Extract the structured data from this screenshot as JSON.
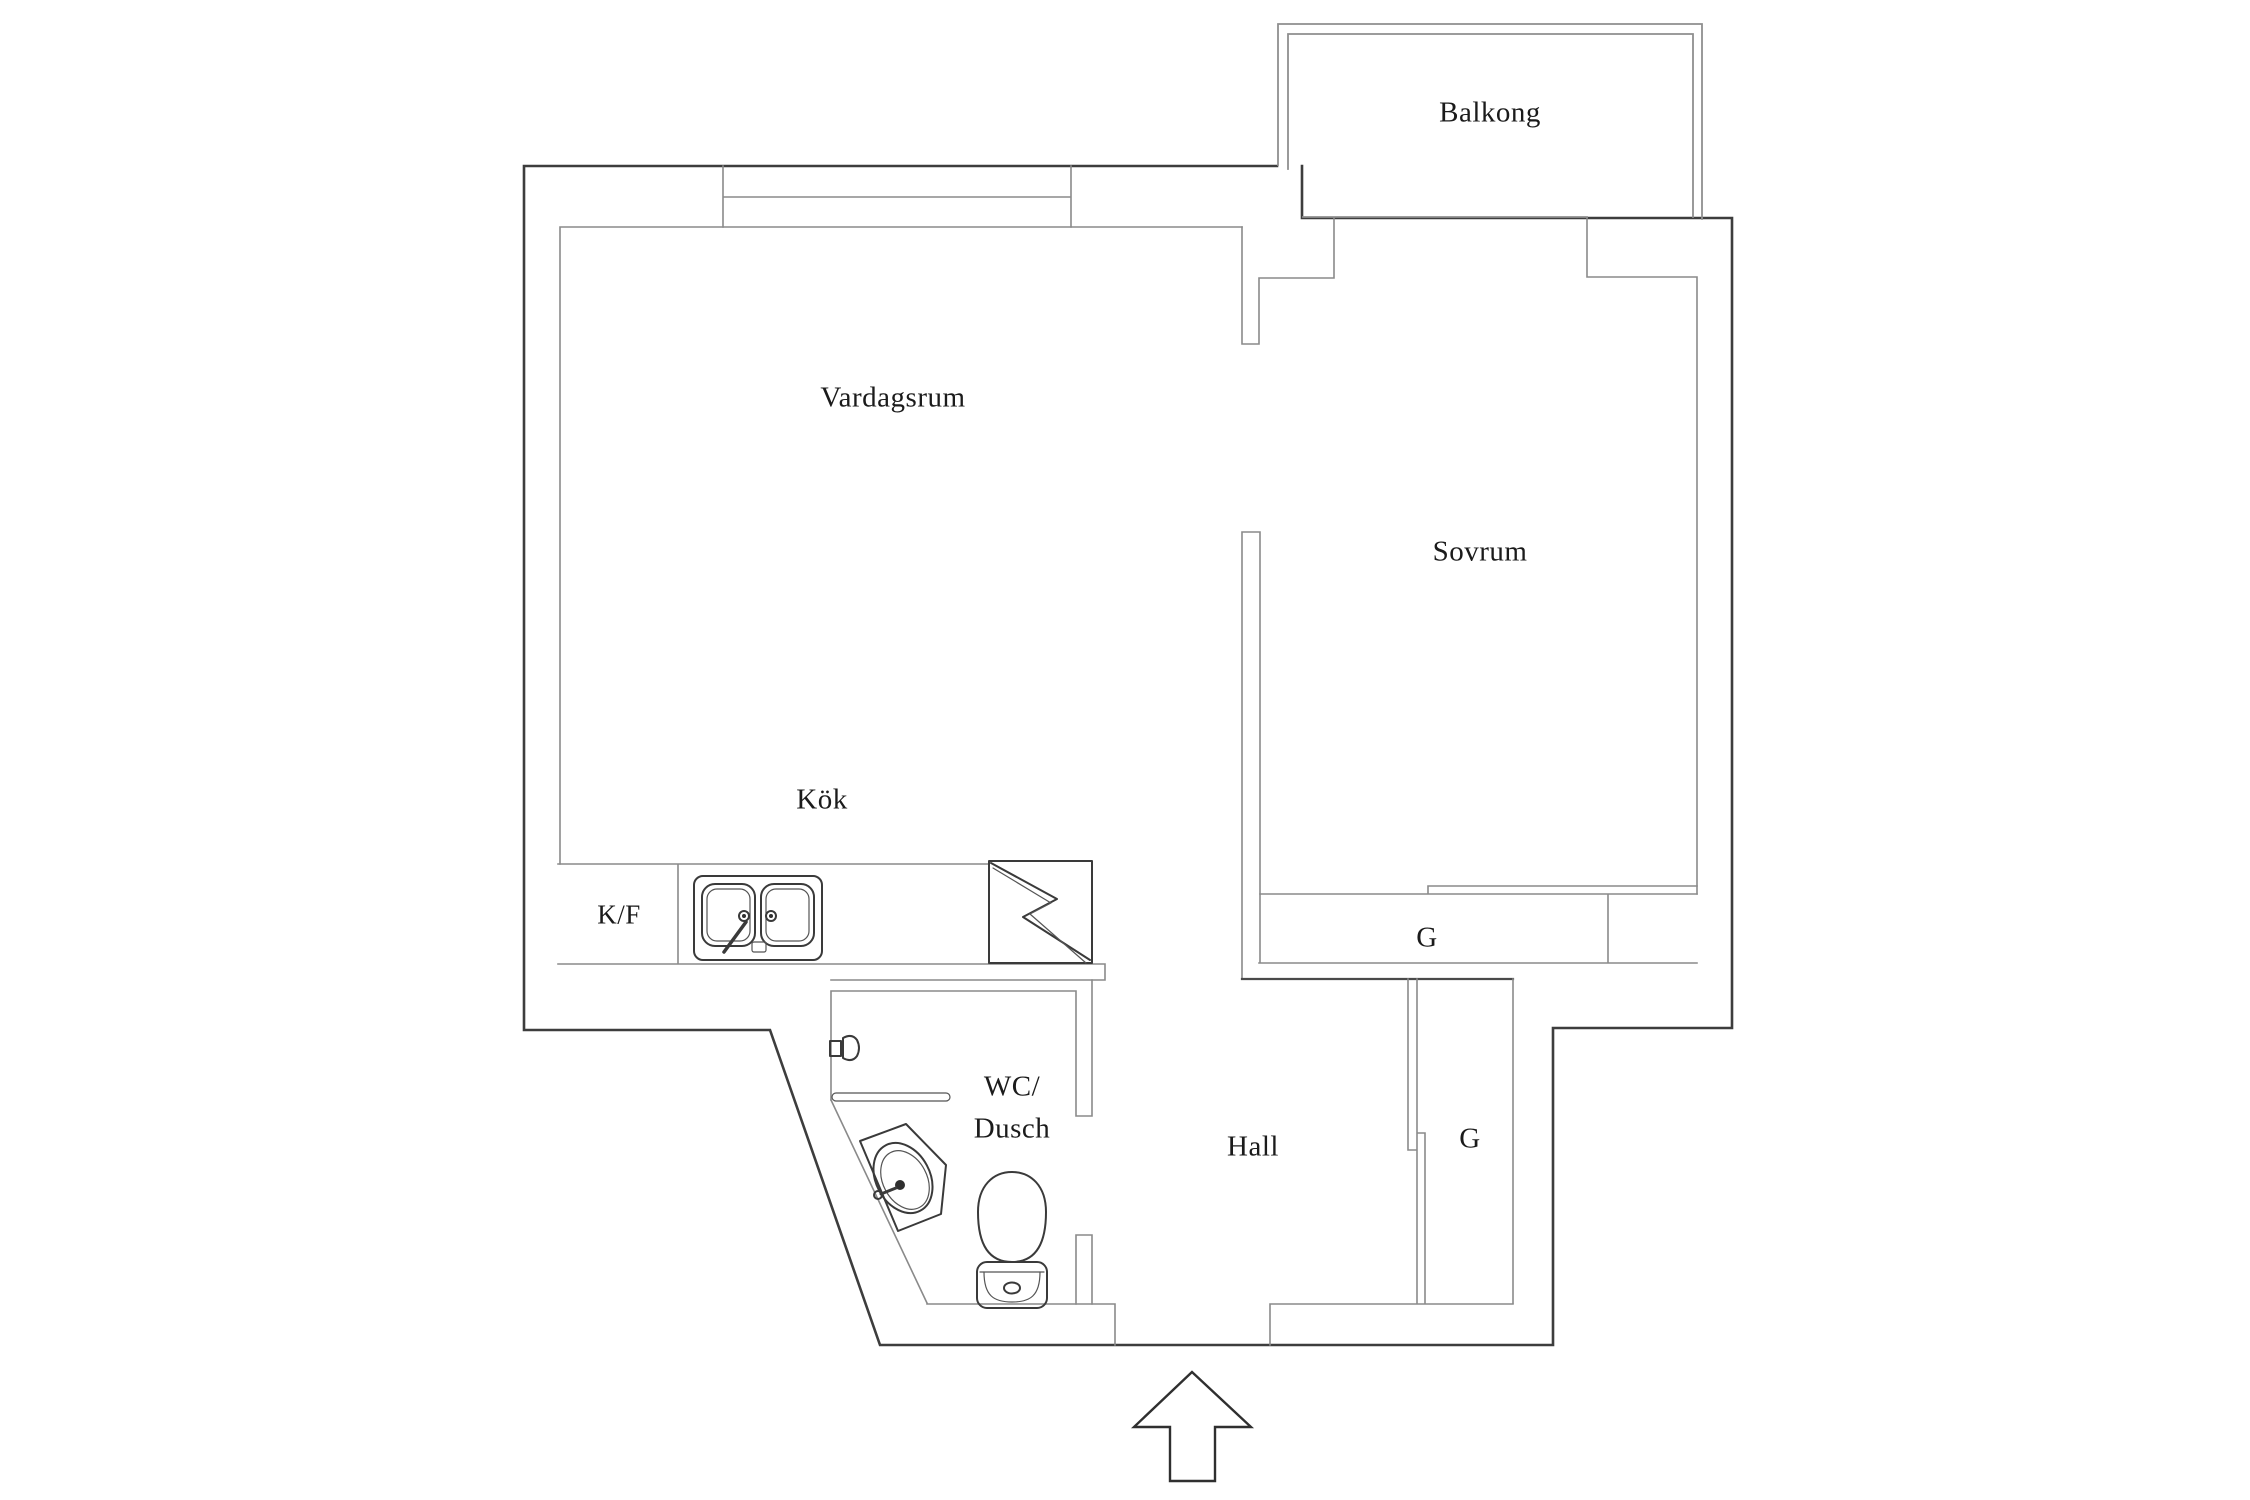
{
  "title": "Apartment floor plan",
  "colors": {
    "background": "#ffffff",
    "outer_wall": "#3d3d3d",
    "inner_wall": "#8a8a8a",
    "text": "#1b1b1b"
  },
  "rooms": {
    "balcony": {
      "label": "Balkong"
    },
    "living_room": {
      "label": "Vardagsrum"
    },
    "kitchen": {
      "label": "Kök"
    },
    "fridge_freezer": {
      "label": "K/F"
    },
    "bedroom": {
      "label": "Sovrum"
    },
    "wc_line1": {
      "label": "WC/"
    },
    "wc_line2": {
      "label": "Dusch"
    },
    "hall": {
      "label": "Hall"
    },
    "wardrobe_bedroom": {
      "label": "G"
    },
    "wardrobe_hall": {
      "label": "G"
    }
  },
  "icons": {
    "stove": "stove-icon",
    "sink": "kitchen-sink-icon",
    "washbasin": "washbasin-icon",
    "toilet": "toilet-icon",
    "shower_mixer": "shower-mixer-icon",
    "towel_bar": "towel-bar-icon",
    "entry_arrow": "entry-arrow-icon"
  }
}
